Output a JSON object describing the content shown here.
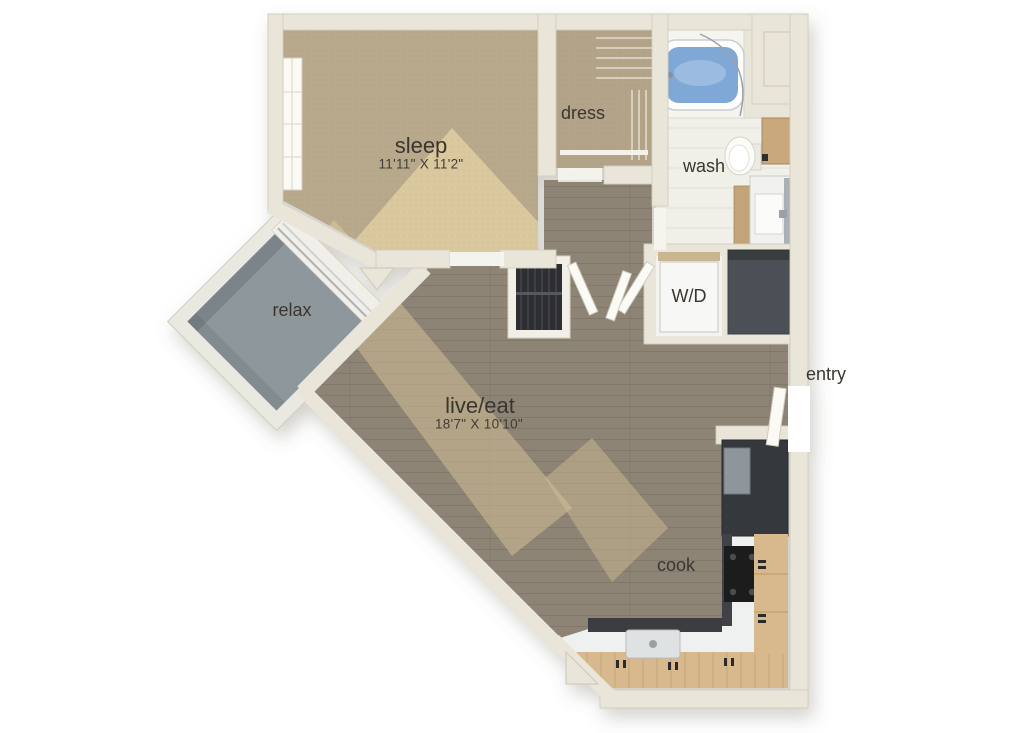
{
  "plan": {
    "type": "apartment-floor-plan",
    "background": "#ffffff"
  },
  "labels": {
    "sleep": {
      "name": "sleep",
      "dims": "11'11\" X 11'2\""
    },
    "dress": {
      "name": "dress"
    },
    "wash": {
      "name": "wash"
    },
    "laundry": {
      "name": "W/D"
    },
    "relax": {
      "name": "relax"
    },
    "live_eat": {
      "name": "live/eat",
      "dims": "18'7\" X 10'10\""
    },
    "cook": {
      "name": "cook"
    },
    "entry": {
      "name": "entry"
    }
  },
  "palette": {
    "wall": "#e9e5d8",
    "wall_edge": "#d2cdbd",
    "carpet": "#b8a98c",
    "carpet_sun": "#efddab",
    "wood": "#8e8475",
    "wood_sun": "#d2c096",
    "tile": "#f0efe8",
    "balcony_concrete": "#8e979c",
    "cabinet_wood": "#d8b98d",
    "counter": "#eff0f0",
    "appliance_dark": "#34373c",
    "utility_dark": "#4c5056",
    "tub_water": "#7fa8d6",
    "label_text": "#3a362f"
  }
}
